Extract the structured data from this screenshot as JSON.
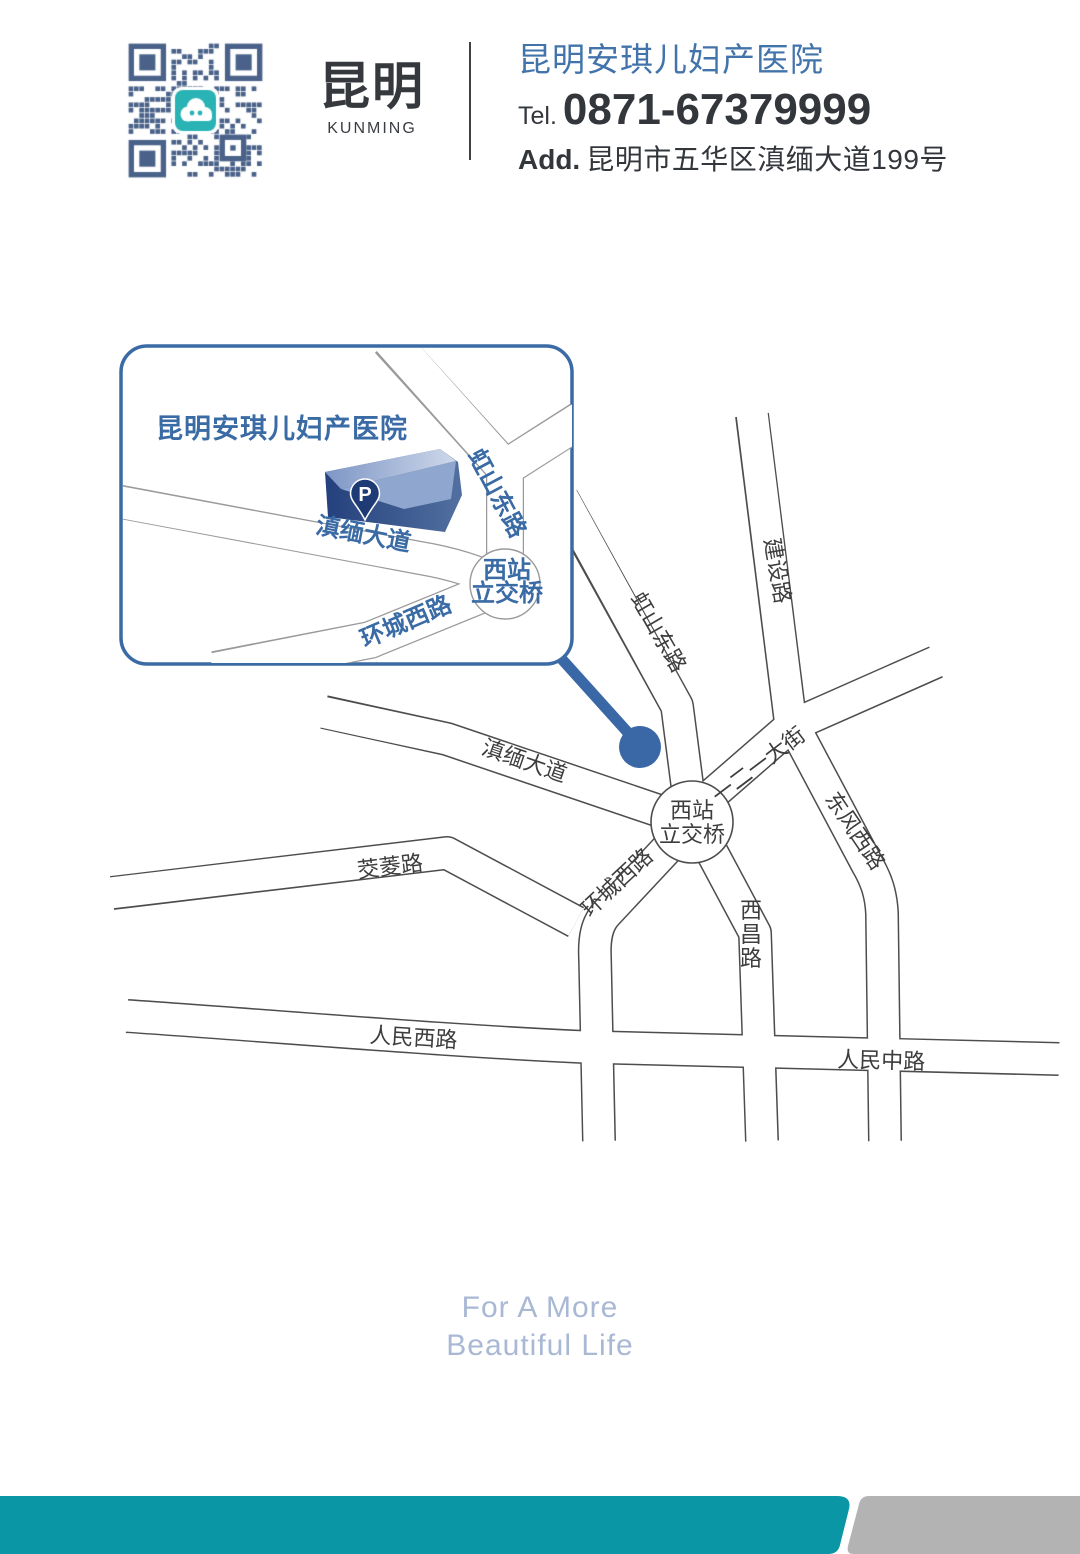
{
  "header": {
    "brand": {
      "cn": "昆明",
      "en": "KUNMING"
    },
    "hospital": {
      "name": "昆明安琪儿妇产医院",
      "tel_label": "Tel.",
      "tel": "0871-67379999",
      "addr_label": "Add.",
      "address": "昆明市五华区滇缅大道199号"
    }
  },
  "inset": {
    "title": "昆明安琪儿妇产医院",
    "parking": "P",
    "roads": {
      "dianmian": "滇缅大道",
      "hongshan": "虹山东路",
      "huancheng": "环城西路",
      "interchange1": "西站",
      "interchange2": "立交桥"
    }
  },
  "map": {
    "roads": {
      "jianshe": "建设路",
      "hongshan": "虹山东路",
      "dianmian": "滇缅大道",
      "yieryi": "一二一大街",
      "dongfeng": "东风西路",
      "huancheng": "环城西路",
      "jiaoling": "茭菱路",
      "xichang": "西昌路",
      "renmin_west": "人民西路",
      "renmin_middle": "人民中路",
      "interchange1": "西站",
      "interchange2": "立交桥"
    }
  },
  "footer": {
    "line1": "For A More",
    "line2": "Beautiful Life"
  },
  "colors": {
    "accent_blue": "#3a6ba5",
    "header_name_blue": "#4274ab",
    "marker_blue": "#3a67a5",
    "road_line": "#4d4d4d",
    "inset_line": "#9a9a9a",
    "teal_bar": "#0b96a6",
    "gray_bar": "#b3b3b3",
    "slogan": "#a9b8d4",
    "qr_blue": "#4a6289",
    "qr_logo_teal": "#2ab3b4",
    "pin_navy": "#1e3b76"
  }
}
